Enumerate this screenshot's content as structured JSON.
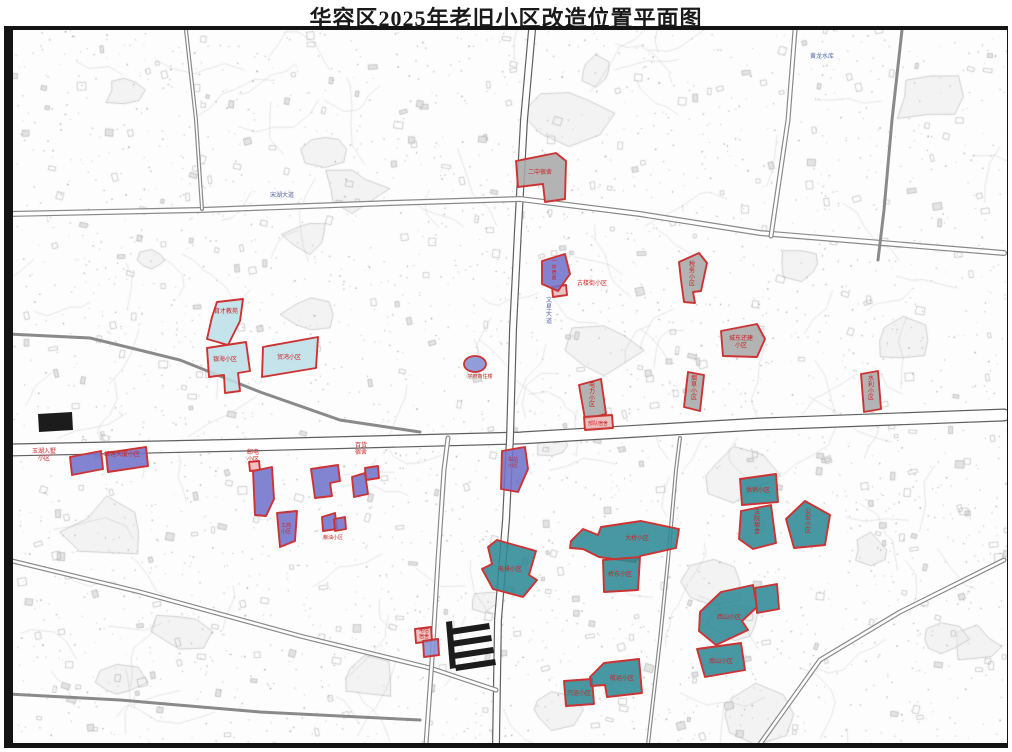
{
  "title": "华容区2025年老旧小区改造位置平面图",
  "colors": {
    "gray": "#a9a9a9",
    "cyan": "#bcdfe7",
    "purple": "#7273cb",
    "blue": "#8693d6",
    "teal": "#2f8a96",
    "pink": "#e9b9b9",
    "parcel_stroke": "#cd3333",
    "label_red": "#cc2222",
    "road_casing": "#8a8a8a",
    "road_dark": "#606060",
    "road_label_blue": "#5566aa",
    "building_black": "#1c1c1c"
  },
  "parcels": [
    {
      "id": "gray-1",
      "color": "gray",
      "points": "516,161 556,153 566,161 565,199 545,202 543,184 518,187",
      "label": {
        "lines": [
          "二中宿舍"
        ],
        "x": 540,
        "y": 174,
        "vertical": false,
        "size": 6
      }
    },
    {
      "id": "gray-2",
      "color": "gray",
      "points": "679,262 699,253 707,263 701,291 693,292 695,303 684,302 681,280",
      "label": {
        "lines": [
          "税务小区"
        ],
        "x": 692,
        "y": 266,
        "vertical": true,
        "size": 6
      }
    },
    {
      "id": "gray-3",
      "color": "gray",
      "points": "721,331 757,324 765,339 757,357 723,356",
      "label": {
        "lines": [
          "城东还建",
          "小区"
        ],
        "x": 741,
        "y": 340,
        "vertical": false,
        "size": 6
      }
    },
    {
      "id": "gray-4",
      "color": "gray",
      "points": "688,372 704,375 700,411 684,407",
      "label": {
        "lines": [
          "烟草小区"
        ],
        "x": 694,
        "y": 380,
        "vertical": true,
        "size": 6
      }
    },
    {
      "id": "gray-5",
      "color": "gray",
      "points": "861,374 878,371 881,409 864,412",
      "label": {
        "lines": [
          "水利小区"
        ],
        "x": 871,
        "y": 380,
        "vertical": true,
        "size": 6
      }
    },
    {
      "id": "gray-6",
      "color": "gray",
      "points": "579,385 601,379 606,414 585,419",
      "label": {
        "lines": [
          "电力小区"
        ],
        "x": 592,
        "y": 387,
        "vertical": true,
        "size": 6
      }
    },
    {
      "id": "pink-1",
      "color": "pink",
      "points": "584,417 612,415 613,428 585,430",
      "label": {
        "lines": [
          "部队宿舍"
        ],
        "x": 598,
        "y": 425,
        "vertical": false,
        "size": 5
      }
    },
    {
      "id": "pink-2",
      "color": "pink",
      "points": "552,287 566,285 567,295 553,297",
      "label": null
    },
    {
      "id": "pink-3",
      "color": "pink",
      "points": "249,462 259,461 260,470 250,471",
      "label": null
    },
    {
      "id": "pink-4",
      "color": "pink",
      "points": "415,629 431,627 432,641 416,643",
      "label": null
    },
    {
      "id": "cyan-1",
      "color": "cyan",
      "points": "217,302 243,299 240,321 228,345 207,339 212,317",
      "label": {
        "lines": [
          "育才教苑"
        ],
        "x": 226,
        "y": 313,
        "vertical": false,
        "size": 6
      }
    },
    {
      "id": "cyan-2",
      "color": "cyan",
      "points": "207,348 246,342 250,371 238,373 240,391 225,393 224,375 209,377",
      "label": {
        "lines": [
          "银海小区"
        ],
        "x": 225,
        "y": 361,
        "vertical": false,
        "size": 6
      }
    },
    {
      "id": "cyan-3",
      "color": "cyan",
      "points": "263,347 318,337 316,368 262,377",
      "label": {
        "lines": [
          "贸鸿小区"
        ],
        "x": 289,
        "y": 359,
        "vertical": false,
        "size": 6
      }
    },
    {
      "id": "blue-oval",
      "color": "blue",
      "type": "ellipse",
      "cx": 475,
      "cy": 364,
      "rx": 11,
      "ry": 8,
      "label": {
        "lines": [
          "学府商住楼"
        ],
        "x": 480,
        "y": 378,
        "vertical": false,
        "size": 5
      }
    },
    {
      "id": "purple-1",
      "color": "purple",
      "points": "70,457 101,451 103,469 72,475",
      "label": null
    },
    {
      "id": "purple-2",
      "color": "purple",
      "points": "106,453 146,447 148,466 108,472",
      "label": null
    },
    {
      "id": "purple-3",
      "color": "purple",
      "points": "542,261 565,254 570,274 558,291 542,284",
      "label": {
        "lines": [
          "一中宿舍"
        ],
        "x": 554,
        "y": 263,
        "vertical": true,
        "size": 5
      }
    },
    {
      "id": "purple-4",
      "color": "purple",
      "points": "253,471 272,467 274,499 266,516 255,515",
      "label": null
    },
    {
      "id": "purple-5",
      "color": "purple",
      "points": "277,513 297,511 295,541 280,547",
      "label": {
        "lines": [
          "工商",
          "小区"
        ],
        "x": 286,
        "y": 527,
        "vertical": false,
        "size": 5
      }
    },
    {
      "id": "purple-6",
      "color": "purple",
      "points": "311,469 338,465 340,481 330,483 332,496 315,498 313,483",
      "label": null
    },
    {
      "id": "purple-7",
      "color": "purple",
      "points": "352,477 365,473 368,494 354,497",
      "label": null
    },
    {
      "id": "purple-8",
      "color": "purple",
      "points": "365,468 378,466 379,478 366,480",
      "label": null
    },
    {
      "id": "purple-9",
      "color": "purple",
      "points": "322,517 335,513 337,529 323,531",
      "label": null
    },
    {
      "id": "purple-10",
      "color": "purple",
      "points": "334,519 345,517 346,529 335,531",
      "label": null
    },
    {
      "id": "purple-11",
      "color": "purple",
      "points": "502,451 525,447 528,469 518,492 501,489",
      "label": {
        "lines": [
          "车站",
          "小区"
        ],
        "x": 513,
        "y": 461,
        "vertical": false,
        "size": 5
      }
    },
    {
      "id": "purple-12",
      "color": "blue",
      "points": "423,641 438,639 439,655 424,657",
      "label": null
    },
    {
      "id": "teal-1",
      "color": "teal",
      "points": "740,479 776,474 778,502 742,505",
      "label": {
        "lines": [
          "供销小区"
        ],
        "x": 758,
        "y": 492,
        "vertical": false,
        "size": 6
      }
    },
    {
      "id": "teal-2",
      "color": "teal",
      "points": "741,511 771,505 776,543 753,549 739,539",
      "label": {
        "lines": [
          "法院宿舍"
        ],
        "x": 757,
        "y": 514,
        "vertical": true,
        "size": 6
      }
    },
    {
      "id": "teal-3",
      "color": "teal",
      "points": "805,501 830,515 825,545 794,548 786,519",
      "label": {
        "lines": [
          "公安小区"
        ],
        "x": 808,
        "y": 513,
        "vertical": true,
        "size": 6
      }
    },
    {
      "id": "teal-4",
      "color": "teal",
      "points": "571,541 583,529 598,535 601,527 641,521 679,529 676,548 640,556 635,562 599,557 583,549 570,548",
      "label": {
        "lines": [
          "大桥小区"
        ],
        "x": 637,
        "y": 540,
        "vertical": false,
        "size": 6
      }
    },
    {
      "id": "teal-5",
      "color": "teal",
      "points": "603,560 640,557 638,590 604,592",
      "label": {
        "lines": [
          "桥东小区"
        ],
        "x": 620,
        "y": 576,
        "vertical": false,
        "size": 6
      }
    },
    {
      "id": "teal-6",
      "color": "teal",
      "points": "497,540 536,551 529,575 537,580 523,597 493,589 482,569 492,564 488,547",
      "label": {
        "lines": [
          "电排小区"
        ],
        "x": 510,
        "y": 571,
        "vertical": false,
        "size": 6
      }
    },
    {
      "id": "teal-7",
      "color": "teal",
      "points": "700,612 721,592 753,585 757,607 742,621 748,630 716,645 699,631",
      "label": {
        "lines": [
          "西山小区"
        ],
        "x": 729,
        "y": 619,
        "vertical": false,
        "size": 6
      }
    },
    {
      "id": "teal-8",
      "color": "teal",
      "points": "755,588 777,584 779,609 757,613",
      "label": null
    },
    {
      "id": "teal-9",
      "color": "teal",
      "points": "697,649 741,643 745,670 705,677",
      "label": {
        "lines": [
          "南山小区"
        ],
        "x": 721,
        "y": 663,
        "vertical": false,
        "size": 6
      }
    },
    {
      "id": "teal-10",
      "color": "teal",
      "points": "564,681 592,679 594,704 566,706",
      "label": {
        "lines": [
          "汽运小区"
        ],
        "x": 579,
        "y": 695,
        "vertical": false,
        "size": 6
      }
    },
    {
      "id": "teal-11",
      "color": "teal",
      "points": "590,677 604,663 639,659 642,693 607,697 605,685 591,686",
      "label": {
        "lines": [
          "航运小区"
        ],
        "x": 622,
        "y": 680,
        "vertical": false,
        "size": 6
      }
    }
  ],
  "free_labels": [
    {
      "lines": [
        "玉湖入墅",
        "小区"
      ],
      "x": 44,
      "y": 453,
      "size": 6
    },
    {
      "lines": [
        "红莲大厦小区"
      ],
      "x": 122,
      "y": 456,
      "size": 6
    },
    {
      "lines": [
        "邮电",
        "小区"
      ],
      "x": 253,
      "y": 454,
      "size": 6
    },
    {
      "lines": [
        "百货",
        "宿舍"
      ],
      "x": 361,
      "y": 447,
      "size": 6
    },
    {
      "lines": [
        "古楼街小区"
      ],
      "x": 592,
      "y": 285,
      "size": 6
    },
    {
      "lines": [
        "电信",
        "宿舍"
      ],
      "x": 424,
      "y": 632,
      "size": 5
    },
    {
      "lines": [
        "粮油小区"
      ],
      "x": 333,
      "y": 539,
      "size": 5
    }
  ],
  "road_labels": [
    {
      "text": "宋湖大道",
      "x": 282,
      "y": 197,
      "vertical": false
    },
    {
      "text": "文星大道",
      "x": 549,
      "y": 302,
      "vertical": true
    },
    {
      "text": "黄龙水库",
      "x": 822,
      "y": 58,
      "vertical": false
    }
  ],
  "roads": [
    {
      "pts": [
        [
          8,
          450
        ],
        [
          250,
          445
        ],
        [
          520,
          438
        ],
        [
          760,
          424
        ],
        [
          1004,
          415
        ]
      ],
      "w": 13,
      "dark": true
    },
    {
      "pts": [
        [
          532,
          30
        ],
        [
          524,
          120
        ],
        [
          518,
          230
        ],
        [
          513,
          330
        ],
        [
          510,
          438
        ],
        [
          506,
          520
        ],
        [
          498,
          620
        ],
        [
          496,
          744
        ]
      ],
      "w": 8,
      "dark": true
    },
    {
      "pts": [
        [
          8,
          214
        ],
        [
          200,
          210
        ],
        [
          390,
          203
        ],
        [
          520,
          199
        ],
        [
          640,
          214
        ],
        [
          760,
          233
        ],
        [
          1004,
          253
        ]
      ],
      "w": 6,
      "dark": false
    },
    {
      "pts": [
        [
          771,
          236
        ],
        [
          788,
          120
        ],
        [
          795,
          30
        ]
      ],
      "w": 5,
      "dark": false
    },
    {
      "pts": [
        [
          186,
          30
        ],
        [
          196,
          120
        ],
        [
          202,
          209
        ]
      ],
      "w": 4,
      "dark": false
    },
    {
      "pts": [
        [
          8,
          560
        ],
        [
          140,
          592
        ],
        [
          300,
          636
        ],
        [
          430,
          668
        ],
        [
          496,
          690
        ]
      ],
      "w": 5,
      "dark": false
    },
    {
      "pts": [
        [
          1004,
          560
        ],
        [
          900,
          612
        ],
        [
          820,
          660
        ],
        [
          760,
          744
        ]
      ],
      "w": 5,
      "dark": false
    },
    {
      "pts": [
        [
          648,
          744
        ],
        [
          660,
          640
        ],
        [
          668,
          560
        ],
        [
          676,
          470
        ],
        [
          680,
          438
        ]
      ],
      "w": 4,
      "dark": false
    },
    {
      "pts": [
        [
          426,
          744
        ],
        [
          432,
          660
        ],
        [
          438,
          560
        ],
        [
          444,
          470
        ],
        [
          448,
          438
        ]
      ],
      "w": 5,
      "dark": false
    },
    {
      "pts": [
        [
          8,
          334
        ],
        [
          90,
          338
        ],
        [
          180,
          360
        ],
        [
          260,
          392
        ],
        [
          340,
          420
        ],
        [
          420,
          432
        ]
      ],
      "w": 3,
      "dark": false
    },
    {
      "pts": [
        [
          8,
          694
        ],
        [
          120,
          700
        ],
        [
          260,
          712
        ],
        [
          420,
          720
        ]
      ],
      "w": 3,
      "dark": false
    },
    {
      "pts": [
        [
          902,
          30
        ],
        [
          892,
          120
        ],
        [
          884,
          210
        ],
        [
          878,
          260
        ]
      ],
      "w": 3,
      "dark": false
    }
  ],
  "black_buildings": [
    "449,629 489,623 490,629 450,635",
    "451,641 491,635 492,641 452,647",
    "453,653 493,647 494,653 454,659",
    "455,665 495,659 496,665 456,671",
    "446,622 452,621 456,668 450,669",
    "38,414 72,412 73,430 39,432"
  ]
}
